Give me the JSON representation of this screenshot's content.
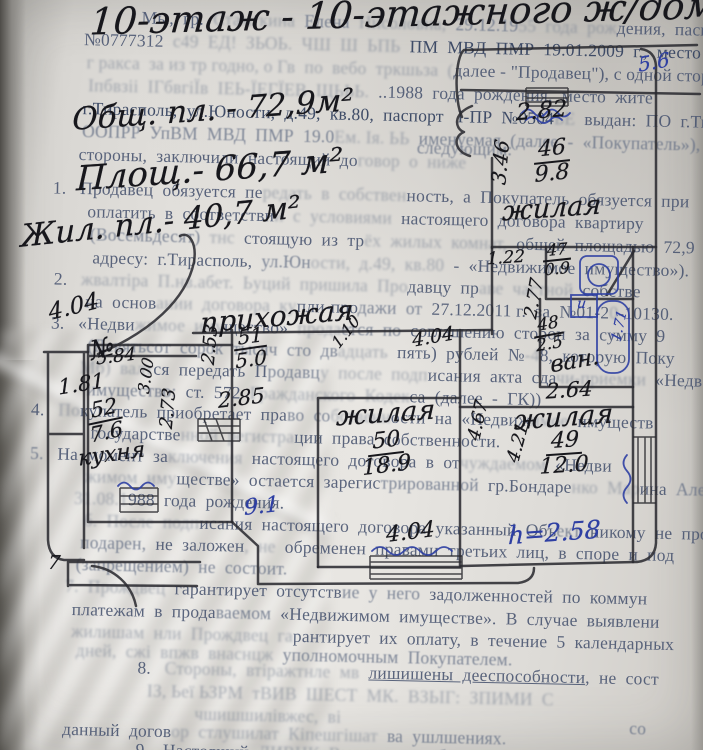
{
  "photo": {
    "paper_color": "#e5e3df",
    "ink_color": "#17171c",
    "blue_pen_color": "#2e3fa3"
  },
  "handwriting": {
    "notes": [
      {
        "t": "10-этаж - 10-этажного ж/дома",
        "x": 90,
        "y": -8,
        "s": 37,
        "r": -1.5
      },
      {
        "t": "Общ. пл. - 72,9м²",
        "x": 72,
        "y": 92,
        "s": 31,
        "r": -4
      },
      {
        "t": "Площ.- 66,7 м²",
        "x": 76,
        "y": 150,
        "s": 34,
        "r": -4
      },
      {
        "t": "Жил. пл.- 40,7 м²",
        "x": 20,
        "y": 204,
        "s": 31,
        "r": -6
      },
      {
        "t": "прихожая",
        "x": 200,
        "y": 300,
        "s": 28,
        "r": -5
      },
      {
        "t": "№",
        "x": 90,
        "y": 334,
        "s": 26,
        "r": -15
      }
    ]
  },
  "plan": {
    "labels": [
      {
        "t": "5.6",
        "x": 638,
        "y": 50,
        "s": 20,
        "r": -10,
        "c": "blue"
      },
      {
        "t": "2.82",
        "x": 516,
        "y": 98,
        "s": 23,
        "r": -5
      },
      {
        "t": "3.46",
        "x": 478,
        "y": 150,
        "s": 20,
        "r": -85
      },
      {
        "top": "46",
        "bot": "9.8",
        "x": 534,
        "y": 138,
        "s": 22,
        "r": -6
      },
      {
        "t": "жилая",
        "x": 502,
        "y": 193,
        "s": 27,
        "r": -4
      },
      {
        "t": "1.22",
        "x": 487,
        "y": 248,
        "s": 17,
        "r": -4
      },
      {
        "top": "47",
        "bot": "0.9",
        "x": 543,
        "y": 242,
        "s": 16,
        "r": -6
      },
      {
        "t": "и",
        "x": 577,
        "y": 296,
        "s": 14,
        "r": 0,
        "c": "blue"
      },
      {
        "t": "1.71",
        "x": 604,
        "y": 318,
        "s": 14,
        "r": -78,
        "c": "blue"
      },
      {
        "t": "2.77",
        "x": 514,
        "y": 288,
        "s": 18,
        "r": -80
      },
      {
        "top": "48",
        "bot": "2.5",
        "x": 534,
        "y": 316,
        "s": 17,
        "r": -10
      },
      {
        "t": "ван.",
        "x": 550,
        "y": 348,
        "s": 23,
        "r": -10
      },
      {
        "t": "2.64",
        "x": 546,
        "y": 378,
        "s": 21,
        "r": -4
      },
      {
        "t": "жилая",
        "x": 514,
        "y": 402,
        "s": 27,
        "r": -4
      },
      {
        "top": "49",
        "bot": "12.0",
        "x": 540,
        "y": 430,
        "s": 22,
        "r": -4
      },
      {
        "t": "h=2.58",
        "x": 508,
        "y": 518,
        "s": 25,
        "r": -4,
        "c": "blue"
      },
      {
        "t": "4.21",
        "x": 498,
        "y": 432,
        "s": 18,
        "r": -75
      },
      {
        "t": "4.67",
        "x": 458,
        "y": 410,
        "s": 18,
        "r": -78
      },
      {
        "t": "жилая",
        "x": 336,
        "y": 398,
        "s": 27,
        "r": -4
      },
      {
        "top": "50",
        "bot": "18.9",
        "x": 362,
        "y": 430,
        "s": 22,
        "r": -7
      },
      {
        "t": "4.04",
        "x": 386,
        "y": 520,
        "s": 22,
        "r": -7
      },
      {
        "t": "9.1",
        "x": 244,
        "y": 494,
        "s": 22,
        "r": -6,
        "c": "blue"
      },
      {
        "top": "51",
        "bot": "5.0",
        "x": 234,
        "y": 326,
        "s": 20,
        "r": -8
      },
      {
        "t": "2.53",
        "x": 190,
        "y": 334,
        "s": 18,
        "r": -85
      },
      {
        "t": "2.85",
        "x": 218,
        "y": 386,
        "s": 21,
        "r": -7
      },
      {
        "t": "1.10",
        "x": 328,
        "y": 322,
        "s": 16,
        "r": -52
      },
      {
        "t": "4.04",
        "x": 412,
        "y": 326,
        "s": 19,
        "r": -10
      },
      {
        "t": "4.04",
        "x": 48,
        "y": 294,
        "s": 23,
        "r": -14
      },
      {
        "t": "5.84",
        "x": 96,
        "y": 346,
        "s": 18,
        "r": -7
      },
      {
        "t": "1.81",
        "x": 58,
        "y": 372,
        "s": 21,
        "r": -9
      },
      {
        "t": "3.00",
        "x": 128,
        "y": 366,
        "s": 16,
        "r": -82
      },
      {
        "top": "52",
        "bot": "7.6",
        "x": 88,
        "y": 398,
        "s": 21,
        "r": -12
      },
      {
        "t": "кухня",
        "x": 78,
        "y": 442,
        "s": 22,
        "r": -8
      },
      {
        "t": "2.73",
        "x": 148,
        "y": 398,
        "s": 18,
        "r": -85
      },
      {
        "t": "7",
        "x": 48,
        "y": 552,
        "s": 19,
        "r": 0
      }
    ]
  },
  "printed": {
    "lines": [
      {
        "x": 142,
        "y": 6,
        "parts": [
          {
            "t": "Мы,  гр.  ",
            "c": "p2"
          },
          {
            "t": "Стамгкина  ",
            "c": "p4"
          },
          {
            "t": "Елена  ",
            "c": "p3"
          },
          {
            "t": "Нисоловна,  ",
            "c": "p4"
          },
          {
            "t": "29.12.19",
            "c": "p3"
          },
          {
            "t": "55  года  рож",
            "c": "p4"
          },
          {
            "t": "дения,  паспорт",
            "c": "p2"
          }
        ]
      },
      {
        "x": 85,
        "y": 29,
        "parts": [
          {
            "t": "№0777312  ",
            "c": "p2"
          },
          {
            "t": "с49  ЕД!  ЗЬОЬ.  ЧШ  Ш  ЬПЬ  ",
            "c": "p4"
          },
          {
            "t": "ПМ  МВД  ПМР  19.01.2009  г.,  место  жите",
            "c": "p1"
          }
        ]
      },
      {
        "x": 88,
        "y": 52,
        "parts": [
          {
            "t": "г ракса  за из тр годно, о Гв  по  вебо  тркшьза  (",
            "c": "p4"
          },
          {
            "t": "далее - \"Продавец\"), с одной сторо",
            "c": "p2"
          }
        ]
      },
      {
        "x": 90,
        "y": 75,
        "parts": [
          {
            "t": "Іпбвзіі  ІГбвгіЇв  ІЕЬ-ЇЕГЇЕВ  ЩЬЬЬ.  ",
            "c": "p4"
          },
          {
            "t": "..1988  года  рождения,  место  жите",
            "c": "p2"
          }
        ]
      },
      {
        "x": 85,
        "y": 98,
        "parts": [
          {
            "t": "г.Тирасполь,  ул.Юности,  д.49,  кв.80,  паспорт   І-ПР  №0504",
            "c": "p1"
          },
          {
            "t": "ЬЕ  ",
            "c": "p4"
          },
          {
            "t": "выдан:  ПО  г.Тир",
            "c": "p2"
          }
        ]
      },
      {
        "x": 85,
        "y": 121,
        "parts": [
          {
            "t": "ООПРР  УпВМ  МВД  ПМР  19.0",
            "c": "p3"
          },
          {
            "t": "Ем. Ія. ЬЬ  ",
            "c": "p4"
          },
          {
            "t": "именуемая  (далее  -  «Покупатель»),  с",
            "c": "p3"
          }
        ]
      },
      {
        "x": 82,
        "y": 144,
        "parts": [
          {
            "t": "стороны,  заключили  настоящий  до",
            "c": "p2"
          },
          {
            "t": "говор  о  ниже",
            "c": "p4"
          }
        ]
      },
      {
        "x": 420,
        "y": 130,
        "parts": [
          {
            "t": "следующим:",
            "c": "p3"
          }
        ]
      },
      {
        "x": 57,
        "y": 178,
        "parts": [
          {
            "t": "1.   ",
            "c": "p2"
          },
          {
            "t": "Продавец  обязуется  пе",
            "c": "p2"
          },
          {
            "t": "редать  в  собствен",
            "c": "p4"
          },
          {
            "t": "ность,  а  Покупатель  обязуется  при",
            "c": "p2"
          }
        ]
      },
      {
        "x": 92,
        "y": 201,
        "parts": [
          {
            "t": "оплатить  в  соответстви",
            "c": "p2"
          },
          {
            "t": "и  с  условиями  ",
            "c": "p4"
          },
          {
            "t": "настоящего  договора  квартиру",
            "c": "p2"
          }
        ]
      },
      {
        "x": 95,
        "y": 224,
        "parts": [
          {
            "t": "(Восемьдесят)  ",
            "c": "p3"
          },
          {
            "t": "тнс  ",
            "c": "p4"
          },
          {
            "t": "стоящую  из  тр",
            "c": "p2"
          },
          {
            "t": "ёх  жилых  комнат,  ",
            "c": "p4"
          },
          {
            "t": "общей  площадью  72,9  кв",
            "c": "p2"
          }
        ]
      },
      {
        "x": 98,
        "y": 247,
        "parts": [
          {
            "t": "адресу:  г.Тирасполь,  ",
            "c": "p2"
          },
          {
            "t": "ул.Юн",
            "c": "p3"
          },
          {
            "t": "ости,  д.49,  кв.80  ",
            "c": "p4"
          },
          {
            "t": "-  «Недвижимое  имущество»).",
            "c": "p2"
          }
        ]
      },
      {
        "x": 60,
        "y": 269,
        "parts": [
          {
            "t": "2.   ",
            "c": "p2"
          },
          {
            "t": "жвалтіра  П.нв.абет.  Ьуций  пришила  Про",
            "c": "p4"
          },
          {
            "t": "давцу  пр",
            "c": "p2"
          },
          {
            "t": "аве  частной",
            "c": "p4"
          },
          {
            "t": "  собстве",
            "c": "p2"
          }
        ]
      },
      {
        "x": 92,
        "y": 291,
        "parts": [
          {
            "t": "на  основ",
            "c": "p2"
          },
          {
            "t": "ании  договора  ку",
            "c": "p4"
          },
          {
            "t": "пли-про",
            "c": "p2"
          },
          {
            "t": "дажи  от  ",
            "c": "p3"
          },
          {
            "t": "27.12.2011 г.  за  №01-2",
            "c": "p2"
          },
          {
            "t": "0",
            "c": "p4"
          },
          {
            "t": "-10130.",
            "c": "p2"
          }
        ]
      },
      {
        "x": 58,
        "y": 313,
        "parts": [
          {
            "t": "3.   ",
            "c": "p2"
          },
          {
            "t": "«Недви",
            "c": "p2"
          },
          {
            "t": "жимое  иму",
            "c": "p4"
          },
          {
            "t": "щество»  ",
            "c": "p2"
          },
          {
            "t": "прода",
            "c": "p4"
          },
          {
            "t": "ется  по  ",
            "c": "p3"
          },
          {
            "t": "соглашению  сторон  за  сумму  9",
            "c": "p2"
          }
        ]
      },
      {
        "x": 95,
        "y": 335,
        "parts": [
          {
            "t": "(Девятьсот  сорок  тысяч  сто  дв",
            "c": "p3"
          },
          {
            "t": "адцать  ",
            "c": "p4"
          },
          {
            "t": "пять)  рублей  №",
            "c": "p2"
          },
          {
            "t": "-4",
            "c": "p4"
          },
          {
            "t": "8,  которую  Поку",
            "c": "p2"
          }
        ]
      },
      {
        "x": 88,
        "y": 357,
        "parts": [
          {
            "t": "Мб)  валт",
            "c": "p4"
          },
          {
            "t": "ся  передать  П",
            "c": "p2"
          },
          {
            "t": "родавц",
            "c": "p3"
          },
          {
            "t": "у  после  подп",
            "c": "p4"
          },
          {
            "t": "исания  акта  сда",
            "c": "p2"
          },
          {
            "t": "чи-приемки  ",
            "c": "p4"
          },
          {
            "t": "«Недв",
            "c": "p2"
          }
        ]
      },
      {
        "x": 95,
        "y": 379,
        "parts": [
          {
            "t": "имущество:  ",
            "c": "p3"
          },
          {
            "t": "ст.  572  ",
            "c": "p2"
          },
          {
            "t": "Гражданского  Кодек",
            "c": "p4"
          },
          {
            "t": "са  (далее  -  ГК))",
            "c": "p2"
          }
        ]
      },
      {
        "x": 40,
        "y": 400,
        "parts": [
          {
            "t": "4.   ",
            "c": "p2"
          },
          {
            "t": "По",
            "c": "p4"
          },
          {
            "t": "купатель  приобретает  пра",
            "c": "p2"
          },
          {
            "t": "во  со",
            "c": "p3"
          },
          {
            "t": "бственн",
            "c": "p4"
          },
          {
            "t": "ости  на  «Недвиж",
            "c": "p2"
          },
          {
            "t": "имое",
            "c": "p4"
          },
          {
            "t": "  имуществ",
            "c": "p2"
          }
        ]
      },
      {
        "x": 100,
        "y": 422,
        "parts": [
          {
            "t": "государстве",
            "c": "p2"
          },
          {
            "t": "нной  регистра",
            "c": "p4"
          },
          {
            "t": "ции  права  собственности.",
            "c": "p2"
          }
        ]
      },
      {
        "x": 40,
        "y": 444,
        "parts": [
          {
            "t": "5.   ",
            "c": "p3"
          },
          {
            "t": "На  момент  за",
            "c": "p2"
          },
          {
            "t": "ключения  ",
            "c": "p4"
          },
          {
            "t": "настоящего  договора  в  от",
            "c": "p2"
          },
          {
            "t": "чуждаемом  ",
            "c": "p4"
          },
          {
            "t": "«Недви",
            "c": "p2"
          }
        ]
      },
      {
        "x": 95,
        "y": 466,
        "parts": [
          {
            "t": "жимом  иму",
            "c": "p4"
          },
          {
            "t": "ществе»  остается  зарегис",
            "c": "p2"
          },
          {
            "t": "трированной  ",
            "c": "p3"
          },
          {
            "t": "гр.Бондаре",
            "c": "p2"
          },
          {
            "t": "нко  Мар",
            "c": "p4"
          },
          {
            "t": "ина  ",
            "c": "p2"
          },
          {
            "t": "Александ",
            "c": "p3"
          }
        ]
      },
      {
        "x": 85,
        "y": 488,
        "parts": [
          {
            "t": "31.08.1",
            "c": "p4"
          },
          {
            "t": "988  года  рождения.",
            "c": "p2"
          }
        ]
      },
      {
        "x": 95,
        "y": 510,
        "parts": [
          {
            "t": "б.  После  подп",
            "c": "p4"
          },
          {
            "t": "исания  настоящего  договора  указанный  Объ",
            "c": "p2"
          },
          {
            "t": "ект  ",
            "c": "p3"
          },
          {
            "t": "никому  не  про",
            "c": "p2"
          }
        ]
      },
      {
        "x": 92,
        "y": 532,
        "parts": [
          {
            "t": "подарен,",
            "c": "p3"
          },
          {
            "t": "  не  заложен",
            "c": "p2"
          },
          {
            "t": ",  не  ",
            "c": "p4"
          },
          {
            "t": "обременен  правами  третьих  ",
            "c": "p2"
          },
          {
            "t": "лиц,  в  споре  и  под",
            "c": "p2"
          }
        ]
      },
      {
        "x": 88,
        "y": 554,
        "parts": [
          {
            "t": "(запрещением)  не  состоит.",
            "c": "p3"
          }
        ]
      },
      {
        "x": 78,
        "y": 576,
        "parts": [
          {
            "t": "7.  Прождвец  ",
            "c": "p4"
          },
          {
            "t": "гарантирует  отсутств",
            "c": "p2"
          },
          {
            "t": "ие  у  него  ",
            "c": "p3"
          },
          {
            "t": "задолженностей  по  коммун",
            "c": "p2"
          }
        ]
      },
      {
        "x": 85,
        "y": 599,
        "parts": [
          {
            "t": "платежам  в  прода",
            "c": "p2"
          },
          {
            "t": "ваемом",
            "c": "p3"
          },
          {
            "t": "  «Недвижимом  имуществе».  В  случае  выявлени",
            "c": "p2"
          }
        ]
      },
      {
        "x": 85,
        "y": 621,
        "parts": [
          {
            "t": "жилишам  нли  Прождвец  га",
            "c": "p4"
          },
          {
            "t": "рантирует  их  оплату,  в  течение  5  календарных",
            "c": "p2"
          }
        ]
      },
      {
        "x": 90,
        "y": 640,
        "parts": [
          {
            "t": "дней,  сжі  впжв  внаснцж  ",
            "c": "p4"
          },
          {
            "t": "уполномочным  Покупателем.",
            "c": "p3"
          }
        ]
      },
      {
        "x": 152,
        "y": 656,
        "parts": [
          {
            "t": "8.   ",
            "c": "p2"
          },
          {
            "t": "Стороны,  втіражтнле  мв  ",
            "c": "p4"
          },
          {
            "t": "лишишены  дееспособности",
            "c": "p2 u"
          },
          {
            "t": ",  не  сост",
            "c": "p2"
          }
        ]
      },
      {
        "x": 162,
        "y": 679,
        "parts": [
          {
            "t": "ІЗ, Ьеї ЬЗРМ  тВИВ  ШЕСТ  МК.  ВЗЬІГ:  ЗПИМИ  С",
            "c": "p4"
          }
        ]
      },
      {
        "x": 210,
        "y": 701,
        "parts": [
          {
            "t": "чшишшилівжес,  ві",
            "c": "p4"
          }
        ]
      },
      {
        "x": 645,
        "y": 706,
        "parts": [
          {
            "t": "со",
            "c": "p3"
          }
        ]
      },
      {
        "x": 78,
        "y": 719,
        "parts": [
          {
            "t": "данный  догов",
            "c": "p2"
          },
          {
            "t": "ор  стлушилат  Кіпешгішат",
            "c": "p4"
          },
          {
            "t": "  ва  ушлшениях.",
            "c": "p3"
          }
        ]
      },
      {
        "x": 152,
        "y": 738,
        "parts": [
          {
            "t": "9.   ",
            "c": "p2"
          },
          {
            "t": "Настоящий  ",
            "c": "p2"
          },
          {
            "t": "ЛИВНК  Вмсит  ",
            "c": "p4"
          },
          {
            "t": "весь  объём  соглашений  ме",
            "c": "p3"
          }
        ]
      }
    ]
  }
}
